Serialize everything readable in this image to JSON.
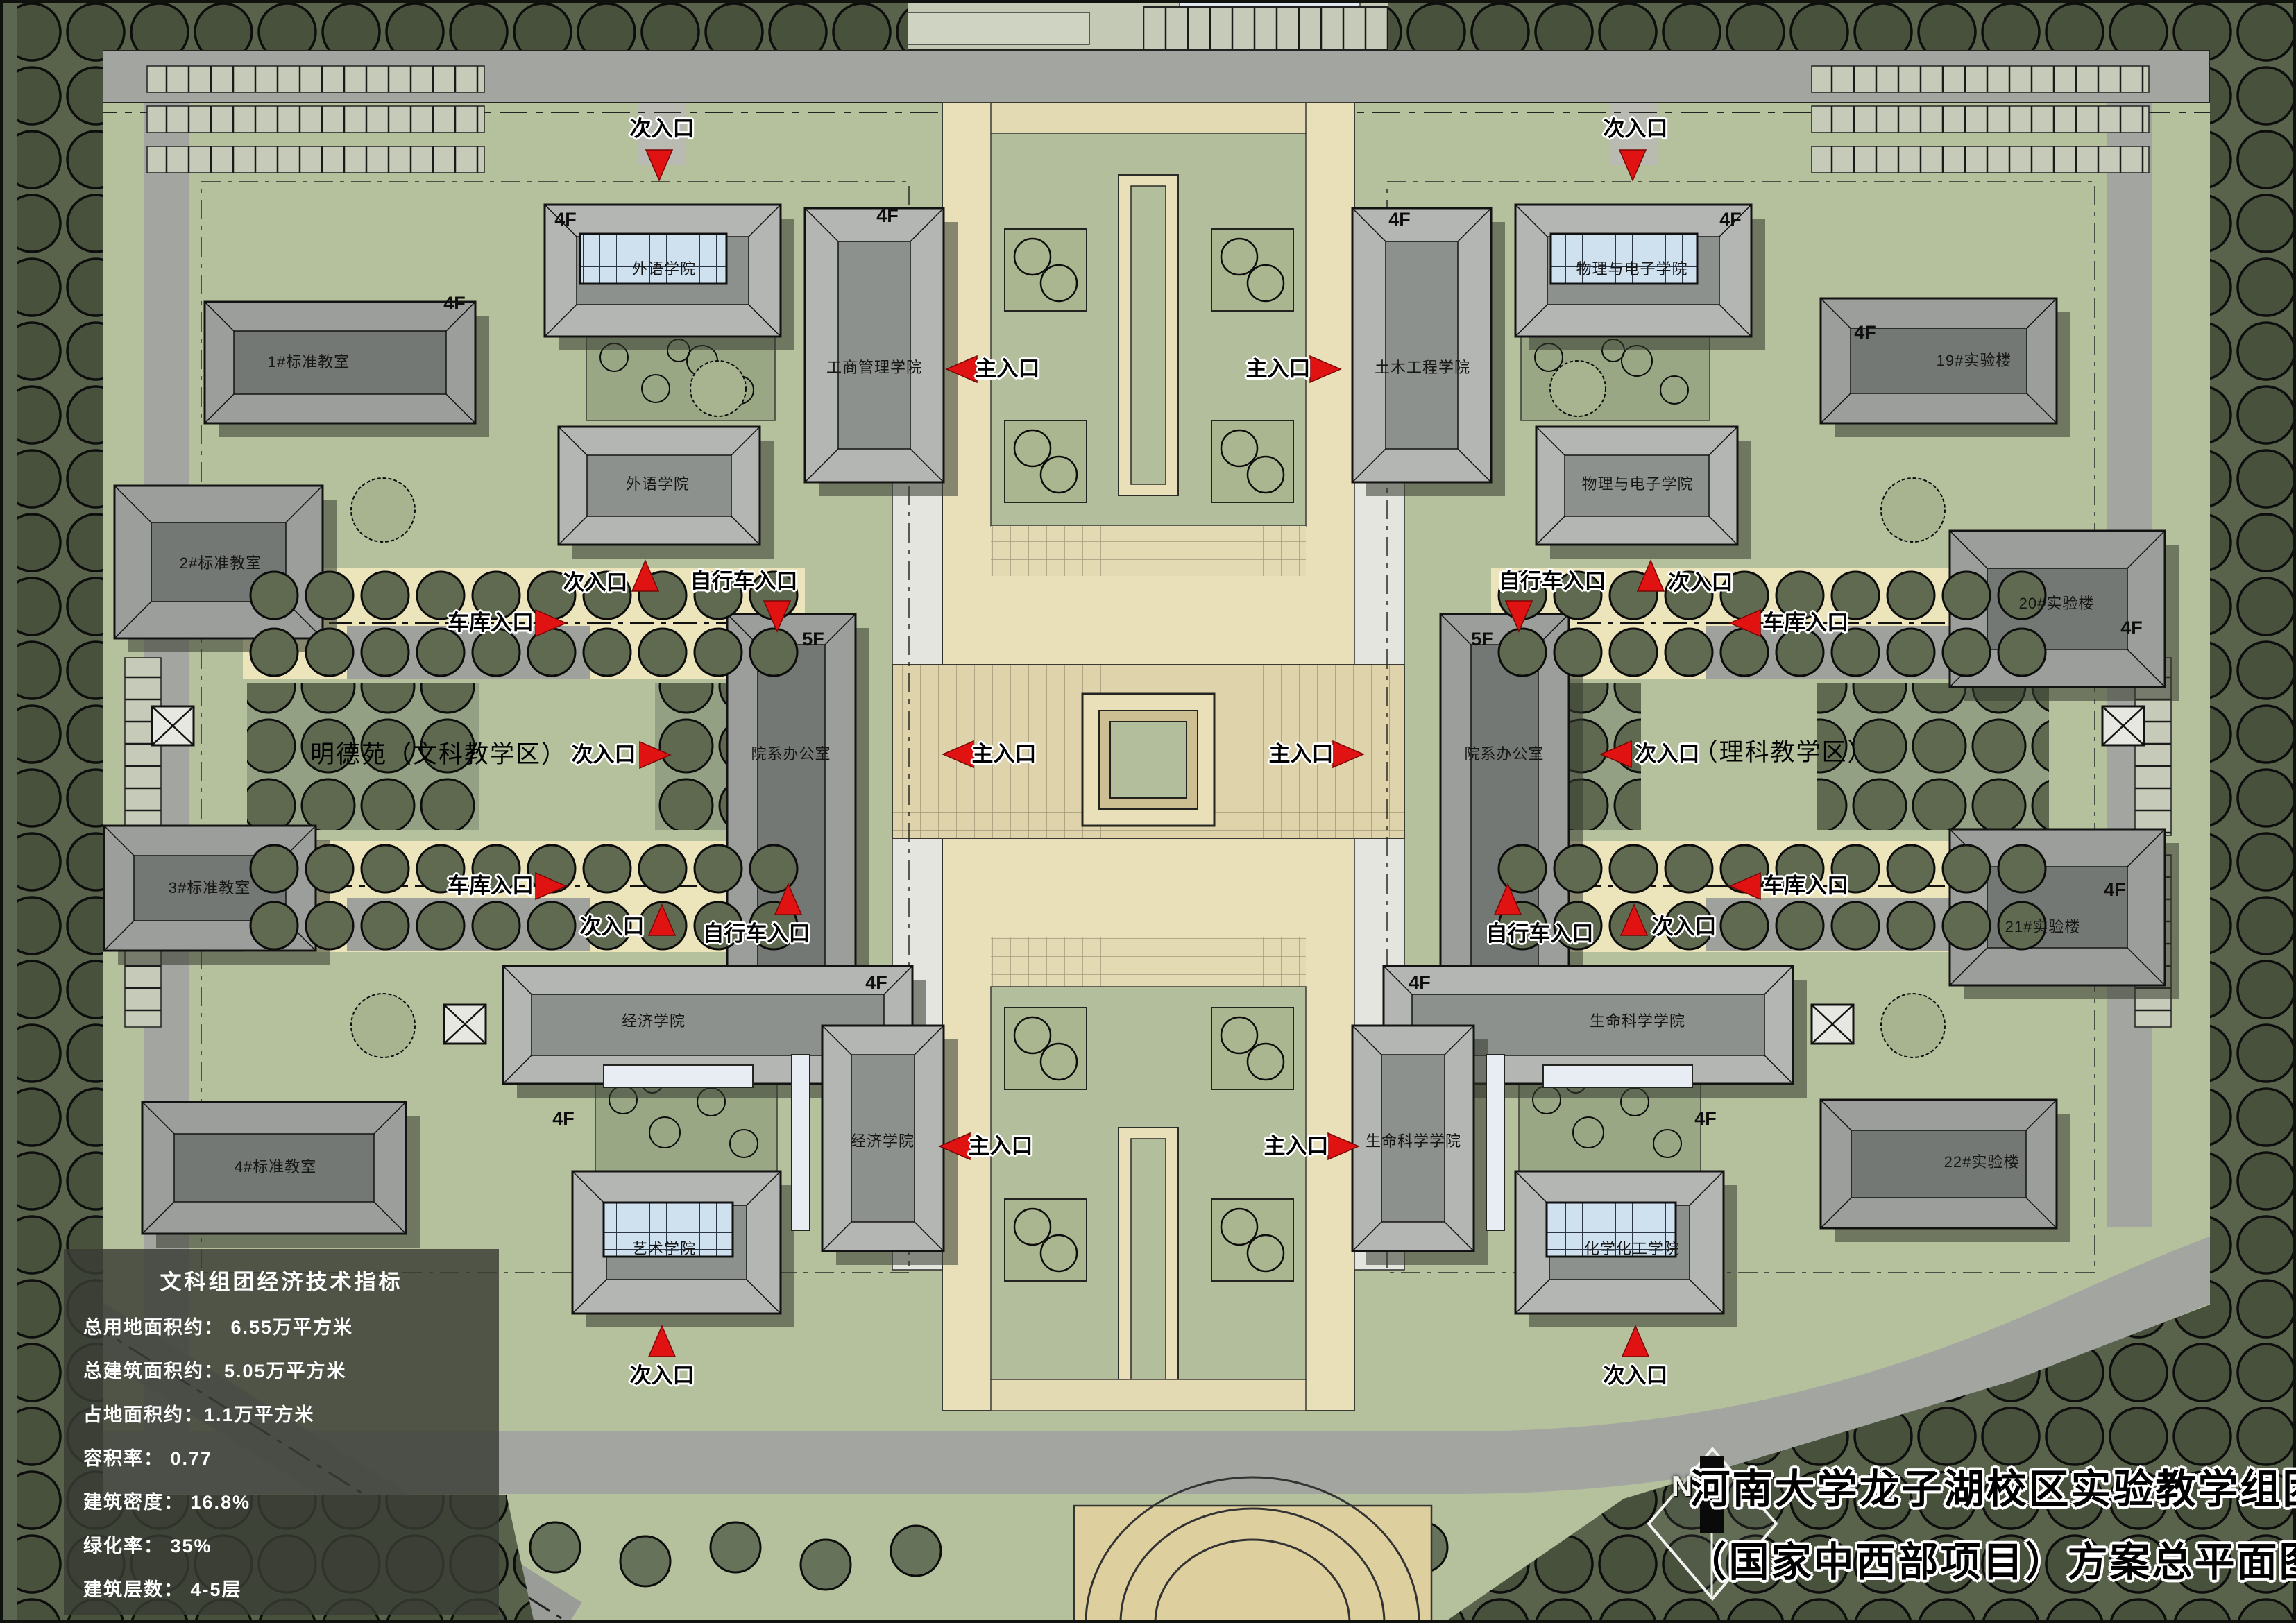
{
  "plan": {
    "name": "campus-master-plan",
    "title_block": {
      "line1": "河南大学龙子湖校区实验教学组团",
      "line2": "（国家中西部项目）方案总平面图",
      "north": "N"
    },
    "legend": {
      "title": "文科组团经济技术指标",
      "rows": [
        "总用地面积约： 6.55万平方米",
        "总建筑面积约：5.05万平方米",
        "占地面积约：1.1万平方米",
        "容积率： 0.77",
        "建筑密度： 16.8%",
        "绿化率： 35%",
        "建筑层数： 4-5层"
      ]
    },
    "district_labels": [
      {
        "id": "liberal-arts",
        "text": "明德苑（文科教学区）"
      },
      {
        "id": "science",
        "text": "（理科教学区）"
      }
    ],
    "building_labels": [
      {
        "id": "std-classroom-1",
        "text": "1#标准教室"
      },
      {
        "id": "std-classroom-2",
        "text": "2#标准教室"
      },
      {
        "id": "std-classroom-3",
        "text": "3#标准教室"
      },
      {
        "id": "std-classroom-4",
        "text": "4#标准教室"
      },
      {
        "id": "foreign-lang-top",
        "text": "外语学院"
      },
      {
        "id": "business-school",
        "text": "工商管理学院"
      },
      {
        "id": "foreign-lang-low",
        "text": "外语学院"
      },
      {
        "id": "dept-office-west",
        "text": "院系办公室"
      },
      {
        "id": "economics-top",
        "text": "经济学院"
      },
      {
        "id": "economics-low",
        "text": "经济学院"
      },
      {
        "id": "art-school",
        "text": "艺术学院"
      },
      {
        "id": "civil-eng",
        "text": "土木工程学院"
      },
      {
        "id": "physics-top",
        "text": "物理与电子学院"
      },
      {
        "id": "physics-low",
        "text": "物理与电子学院"
      },
      {
        "id": "dept-office-east",
        "text": "院系办公室"
      },
      {
        "id": "life-science-top",
        "text": "生命科学学院"
      },
      {
        "id": "life-science-low",
        "text": "生命科学学院"
      },
      {
        "id": "chemistry",
        "text": "化学化工学院"
      },
      {
        "id": "lab-19",
        "text": "19#实验楼"
      },
      {
        "id": "lab-20",
        "text": "20#实验楼"
      },
      {
        "id": "lab-21",
        "text": "21#实验楼"
      },
      {
        "id": "lab-22",
        "text": "22#实验楼"
      }
    ],
    "floor_labels": [
      {
        "text": "4F"
      },
      {
        "text": "4F"
      },
      {
        "text": "4F"
      },
      {
        "text": "4F"
      },
      {
        "text": "4F"
      },
      {
        "text": "4F"
      },
      {
        "text": "4F"
      },
      {
        "text": "4F"
      },
      {
        "text": "4F"
      },
      {
        "text": "4F"
      },
      {
        "text": "4F"
      },
      {
        "text": "4F"
      },
      {
        "text": "4F"
      },
      {
        "text": "5F"
      },
      {
        "text": "5F"
      }
    ],
    "entrance_labels": [
      {
        "id": "main-1",
        "text": "主入口"
      },
      {
        "id": "main-2",
        "text": "主入口"
      },
      {
        "id": "main-3",
        "text": "主入口"
      },
      {
        "id": "main-4",
        "text": "主入口"
      },
      {
        "id": "main-5",
        "text": "主入口"
      },
      {
        "id": "main-6",
        "text": "主入口"
      },
      {
        "id": "secondary-1",
        "text": "次入口"
      },
      {
        "id": "secondary-2",
        "text": "次入口"
      },
      {
        "id": "secondary-3",
        "text": "次入口"
      },
      {
        "id": "secondary-4",
        "text": "次入口"
      },
      {
        "id": "secondary-5",
        "text": "次入口"
      },
      {
        "id": "secondary-6",
        "text": "次入口"
      },
      {
        "id": "secondary-7",
        "text": "次入口"
      },
      {
        "id": "secondary-8",
        "text": "次入口"
      },
      {
        "id": "secondary-9",
        "text": "次入口"
      },
      {
        "id": "secondary-10",
        "text": "次入口"
      },
      {
        "id": "bicycle-1",
        "text": "自行车入口"
      },
      {
        "id": "bicycle-2",
        "text": "自行车入口"
      },
      {
        "id": "bicycle-3",
        "text": "自行车入口"
      },
      {
        "id": "bicycle-4",
        "text": "自行车入口"
      },
      {
        "id": "garage-1",
        "text": "车库入口"
      },
      {
        "id": "garage-2",
        "text": "车库入口"
      },
      {
        "id": "garage-3",
        "text": "车库入口"
      },
      {
        "id": "garage-4",
        "text": "车库入口"
      }
    ],
    "colors": {
      "accent_red": "#e01212",
      "lawn": "#b5c09d",
      "plaza": "#e9e0ba",
      "road": "#a3a5a1",
      "tree_dark": "#47513c",
      "glass_blue": "#cfe0ee"
    }
  }
}
